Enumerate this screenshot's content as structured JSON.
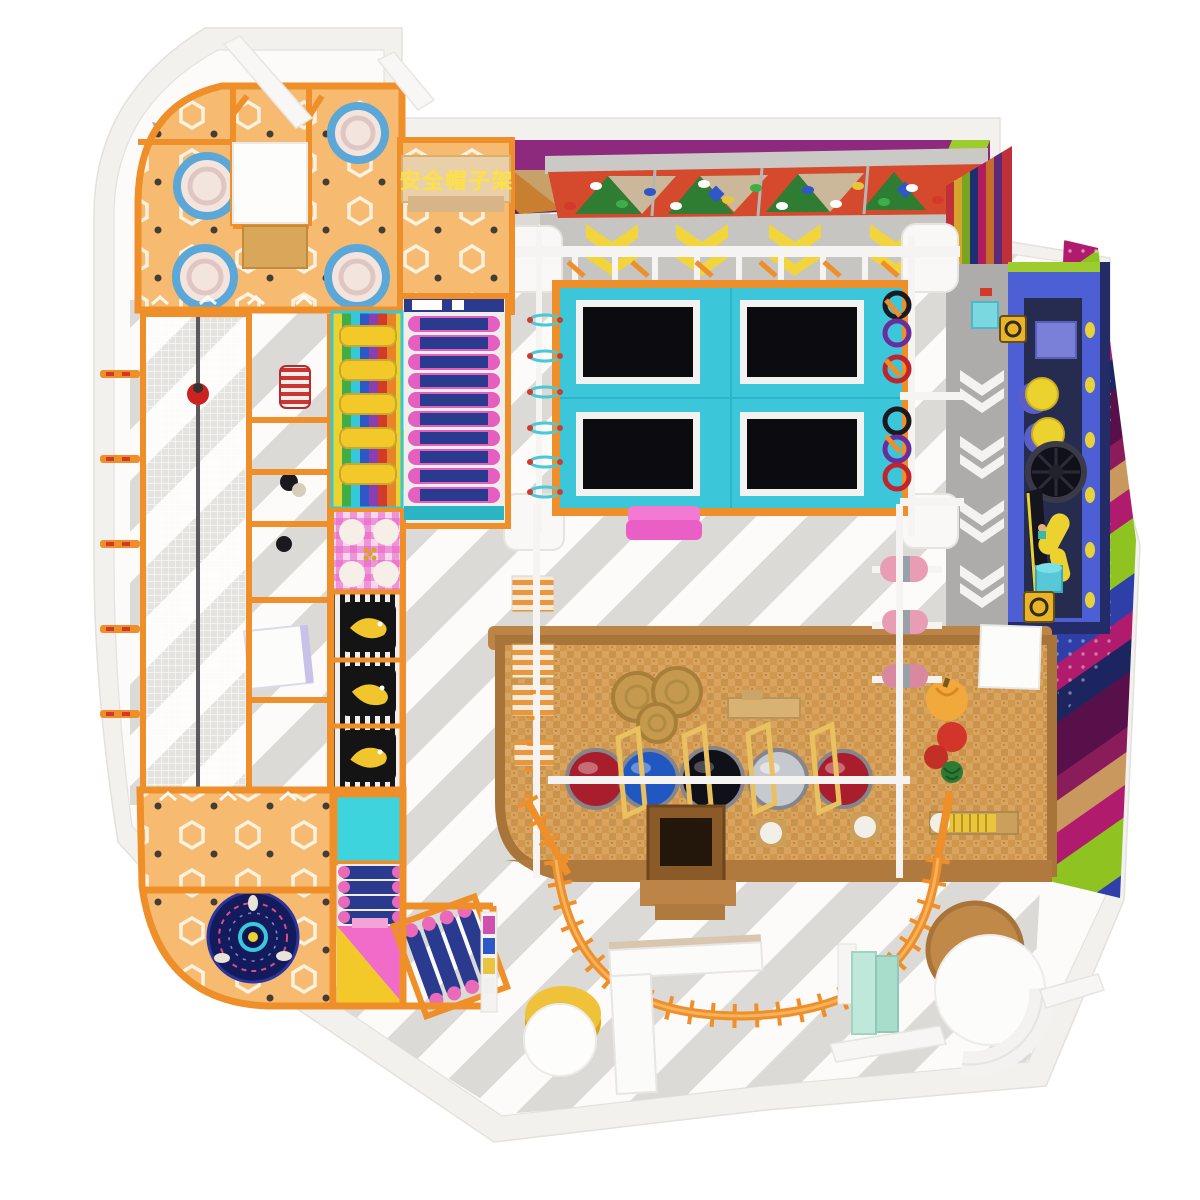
{
  "labels": {
    "helmet_shelf": "安全帽子架"
  },
  "colors": {
    "wall-fill": "#f3f1ee",
    "wall-edge": "#e4e1dc",
    "floor-fill": "#fcfbfa",
    "floor-stripe": "#dcdad6",
    "walkway-top": "#c7c5c1",
    "walkway-right": "#aeacaa",
    "orange-frame": "#ef8f2a",
    "platform-orange": "#f6bb70",
    "platform-shelf-tan": "#e9d0a9",
    "dot-black": "#26262a",
    "ring-blue": "#5aa7d8",
    "pod-cream": "#f3e4de",
    "tramp-deck": "#3cc6da",
    "tramp-mat": "#0c0c10",
    "tramp-frame": "#f2f2f0",
    "ceiling-purple": "#8e2a7e",
    "climb-red": "#d5492c",
    "climb-green": "#2e7d32",
    "climb-tan": "#cbb89a",
    "chev-yellow": "#f2d43c",
    "blue-deck": "#4c5fd4",
    "blue-deck-dark": "#232c66",
    "lime-strip": "#9ccc2e",
    "lane-dark": "#262b50",
    "accent-yellow": "#ecd22e",
    "coin-gold": "#e8b429",
    "teal-bucket": "#57c8d8",
    "wicker": "#d9a45f",
    "wicker-dark": "#c8893c",
    "wood-edge": "#a8743a",
    "wood-bar": "#bd8447",
    "hay": "#c69a4e",
    "ball-red": "#a81e2c",
    "ball-blue": "#2057c0",
    "ball-black": "#101018",
    "ball-silver": "#c6c9cf",
    "ball-rim": "#85858c",
    "arch-gold": "#e9c25f",
    "roller-pink": "#e45fc0",
    "roller-blue": "#2a3b8f",
    "roller-cap": "#e86ab8",
    "slide-yellow": "#f2c928",
    "slide-pink": "#f06cc8",
    "cyan-square": "#3ed4de",
    "gingham-pink": "#e868c8",
    "mat-black": "#161616",
    "mat-white": "#efefef",
    "fish-yellow": "#f0c62c",
    "mat-stripe-orange": "#e8973f",
    "spinner-navy": "#141b5c",
    "spinner-ring": "#3ac8e0",
    "mint": "#bfe8da",
    "gold-stand": "#d9a419",
    "zip-gray": "#5a5a5e",
    "red-ball": "#cc2222",
    "cyl-red": "#cc3333",
    "pink-pad": "#ea5fc6",
    "rw-purple": "#571049",
    "rw-maroon": "#8a1c5c",
    "rw-tan": "#c8985e",
    "rw-magenta": "#b11b6e",
    "rw-lime": "#8fc321",
    "rw-blue": "#2e3fa8",
    "rw-navy": "#1c2560"
  }
}
